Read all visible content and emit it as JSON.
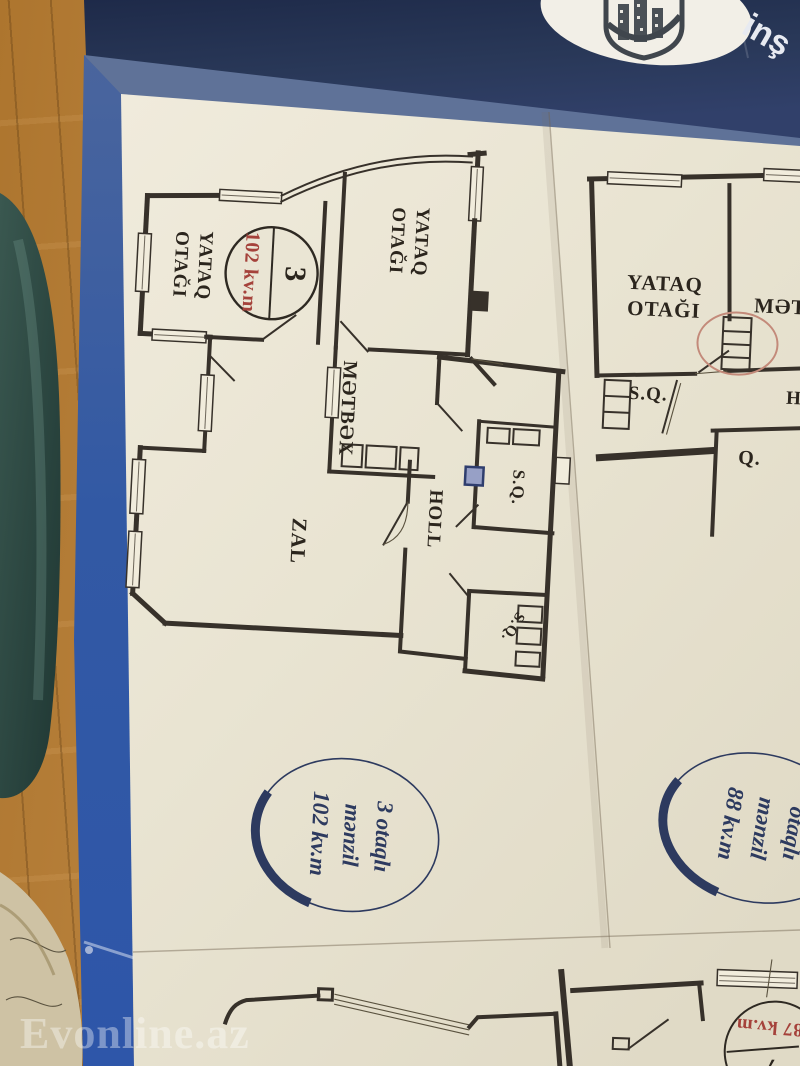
{
  "brochure": {
    "brand_text": "inş",
    "watermark": "Evonline.az"
  },
  "plan_left": {
    "circle": {
      "number": "3",
      "area": "102 kv.m"
    },
    "rooms": {
      "bedroom1_l1": "YATAQ",
      "bedroom1_l2": "OTAĞI",
      "bedroom2_l1": "YATAQ",
      "bedroom2_l2": "OTAĞI",
      "kitchen": "MƏTBƏX",
      "hall": "HOLL",
      "bathroom1": "S.Q.",
      "living_room": "ZAL",
      "bathroom2": "S.Q."
    },
    "summary": {
      "l1": "3 otaqlı",
      "l2": "mənzil",
      "l3": "102 kv.m"
    }
  },
  "plan_right": {
    "rooms": {
      "bedroom_l1": "YATAQ",
      "bedroom_l2": "OTAĞI",
      "kitchen": "MƏTBƏX",
      "bathroom": "S.Q.",
      "room_q": "Q.",
      "hall": "HOLL"
    },
    "summary": {
      "l1": "otaqlı",
      "l2": "mənzil",
      "l3": "88 kv.m"
    }
  },
  "plan_bottom": {
    "badge_area": "87 kv.m",
    "badge_number": "7"
  }
}
